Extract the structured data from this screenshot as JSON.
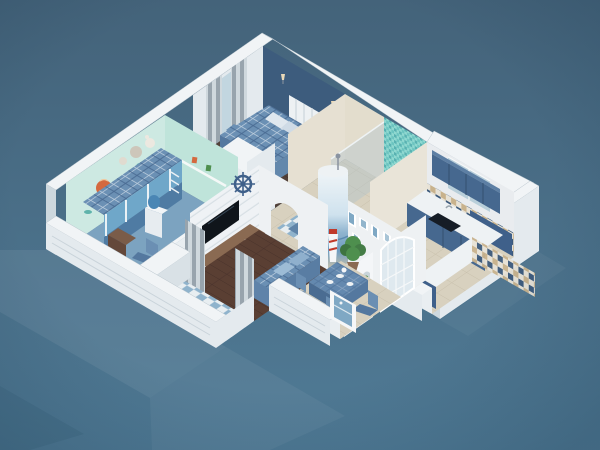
{
  "scene": {
    "kind": "isometric-3d-floor-plan-render",
    "style": "mediterranean-blue-apartment",
    "view": "cutaway-birdseye",
    "rooms": [
      {
        "id": "master-bedroom"
      },
      {
        "id": "kids-bedroom"
      },
      {
        "id": "bathroom-shower"
      },
      {
        "id": "kitchen"
      },
      {
        "id": "hallway-entry"
      },
      {
        "id": "living-room"
      },
      {
        "id": "dining-area"
      },
      {
        "id": "balcony"
      }
    ],
    "furniture": [
      "double-bed-plaid",
      "bunk-bed",
      "wardrobe",
      "tv-console",
      "wall-tv",
      "ship-helm-decor",
      "lighthouse-column-mural",
      "sofa-plaid",
      "dining-table",
      "dining-chairs",
      "kitchen-counter",
      "kitchen-sink",
      "upper-cabinets",
      "potted-plant",
      "leaning-seascape-picture",
      "striped-curtains",
      "water-cooler",
      "hot-air-balloon-decal",
      "stuffed-animals"
    ]
  },
  "palette": {
    "background_top": "#44637a",
    "background_bottom": "#507b96",
    "wall_white": "#e9eef1",
    "wall_top": "#f1f4f6",
    "accent_wall": "#3d5c7d",
    "kids_wall": "#cde9e2",
    "kids_wall_alt": "#bfe4da",
    "kids_carpet": "#7ca3c0",
    "bed_plaid": "#6b90b4",
    "bed_frame": "#6fa7c9",
    "bunk_lower": "#4f7ba3",
    "sofa_back": "#597da3",
    "wood_floor_living": "#5a3f33",
    "wood_floor_bedroom": "#514139",
    "tile_floor": "#d8d1bf",
    "kitchen_cabinet": "#46688f",
    "kitchen_cabinet_dark": "#3f608a",
    "checker_navy": "#3c5a7c",
    "checker_tan": "#c8b28c",
    "checker_cream": "#e7e2d6",
    "balcony_light": "#e8eef1",
    "balcony_blue": "#8fb3cc",
    "mosaic_teal": "#59b2b2",
    "curtain_dark": "#98a4ad",
    "curtain_light": "#cfd8dd",
    "tv_screen": "#10151b",
    "console_wood": "#8a6a52",
    "table_cloth": "#5f83aa",
    "plant_green": "#4e8f4e",
    "balloon_orange": "#d4693f",
    "art_sea": "#7fa8c4",
    "rug_blue": "#5f84a8"
  }
}
